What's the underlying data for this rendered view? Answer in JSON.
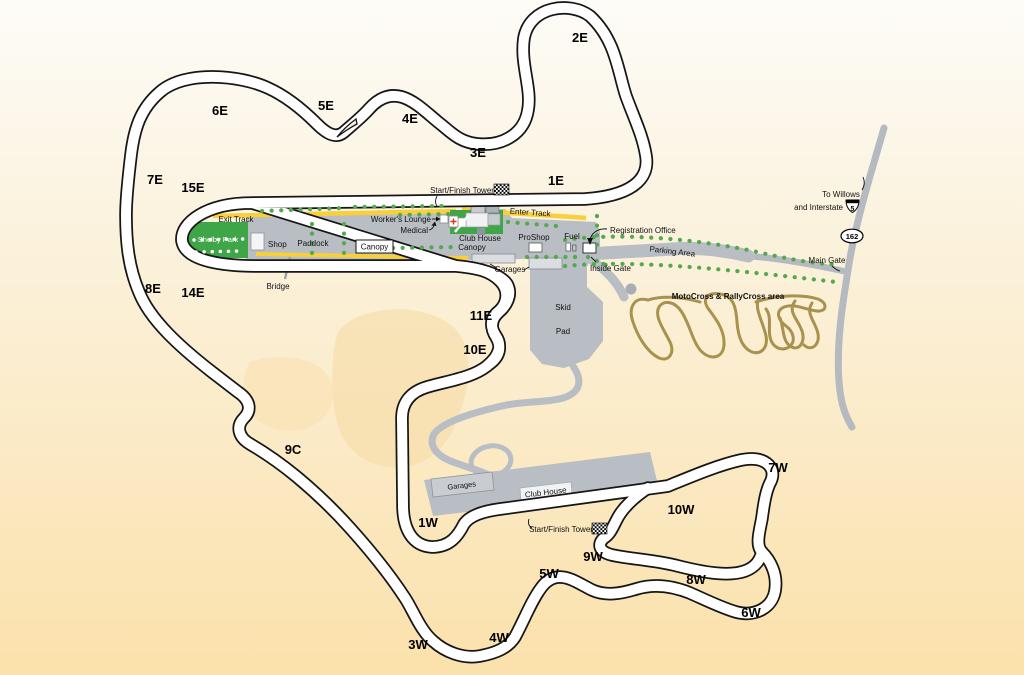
{
  "map": {
    "title": "Thunderhill raceway facility map",
    "turns_east": {
      "t1e": "1E",
      "t2e": "2E",
      "t3e": "3E",
      "t4e": "4E",
      "t5e": "5E",
      "t6e": "6E",
      "t7e": "7E",
      "t8e": "8E",
      "t10e": "10E",
      "t11e": "11E",
      "t14e": "14E",
      "t15e": "15E",
      "t9c": "9C"
    },
    "turns_west": {
      "t1w": "1W",
      "t3w": "3W",
      "t4w": "4W",
      "t5w": "5W",
      "t6w": "6W",
      "t7w": "7W",
      "t8w": "8W",
      "t9w": "9W",
      "t10w": "10W"
    },
    "labels": {
      "start_finish_tower": "Start/Finish Tower",
      "exit_track": "Exit Track",
      "enter_track": "Enter Track",
      "shelby_park": "Shelby Park",
      "shop": "Shop",
      "paddock": "Paddock",
      "bridge": "Bridge",
      "canopy": "Canopy",
      "workers_lounge": "Worker's Lounge",
      "medical": "Medical",
      "club_house": "Club House",
      "club_house_canopy_line2": "Canopy",
      "pro_shop": "ProShop",
      "fuel": "Fuel",
      "registration_office": "Registration Office",
      "inside_gate": "Inside Gate",
      "garages": "Garages",
      "skid_line1": "Skid",
      "skid_line2": "Pad",
      "parking_area": "Parking Area",
      "main_gate": "Main Gate",
      "motocross": "MotoCross & RallyCross area",
      "to_willows_line1": "To Willows",
      "to_willows_line2": "and Interstate",
      "interstate_5": "5",
      "hwy_162": "162"
    },
    "colors": {
      "track_outline": "#161616",
      "road_white": "#ffffff",
      "paddock_gray": "#b9bdc4",
      "building_light": "#dadde1",
      "park_green": "#3fa648",
      "tree_green": "#55a84e",
      "road_yellow": "#f9cf3a",
      "motocross_tan": "#a8924d",
      "highway_gray": "#b5bac1",
      "hill_tan": "#f7dca6",
      "bg_top": "#fdfcf7",
      "bg_bottom": "#fbe1ab"
    }
  }
}
